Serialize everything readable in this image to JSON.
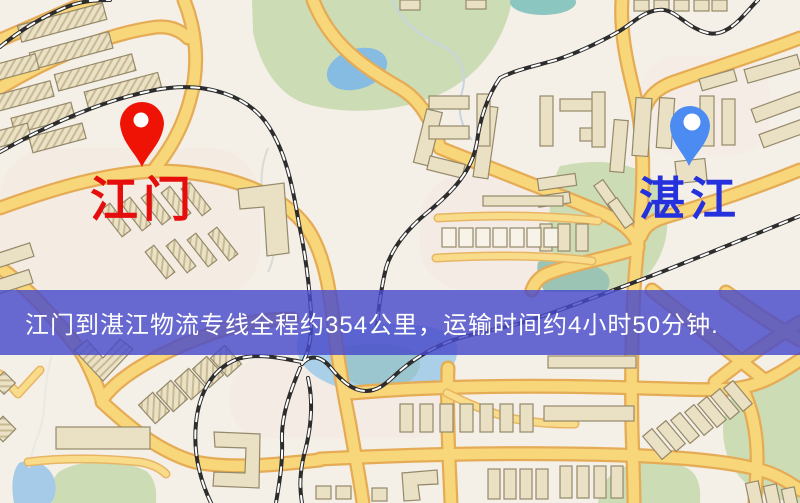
{
  "map": {
    "background_color": "#f4efe7",
    "origin": {
      "name": "江门",
      "pin_icon": "red-pin",
      "pin_color": "#ee1305",
      "label_color": "#e60d0d"
    },
    "destination": {
      "name": "湛江",
      "pin_icon": "blue-pin",
      "pin_color": "#4b8bf2",
      "label_color": "#2431dd"
    },
    "banner": {
      "text": "江门到湛江物流专线全程约354公里，运输时间约4小时50分钟.",
      "background_color": "#484bca",
      "text_color": "#ffffff",
      "distance_km": 354,
      "duration_text": "4小时50分钟"
    },
    "legend_colors": {
      "road": "#f8d674",
      "road_casing": "#e5ab55",
      "railway": "#2d2d2d",
      "water": "#a9cfe9",
      "park": "#ccdcb4",
      "building": "#eae0c4"
    }
  }
}
